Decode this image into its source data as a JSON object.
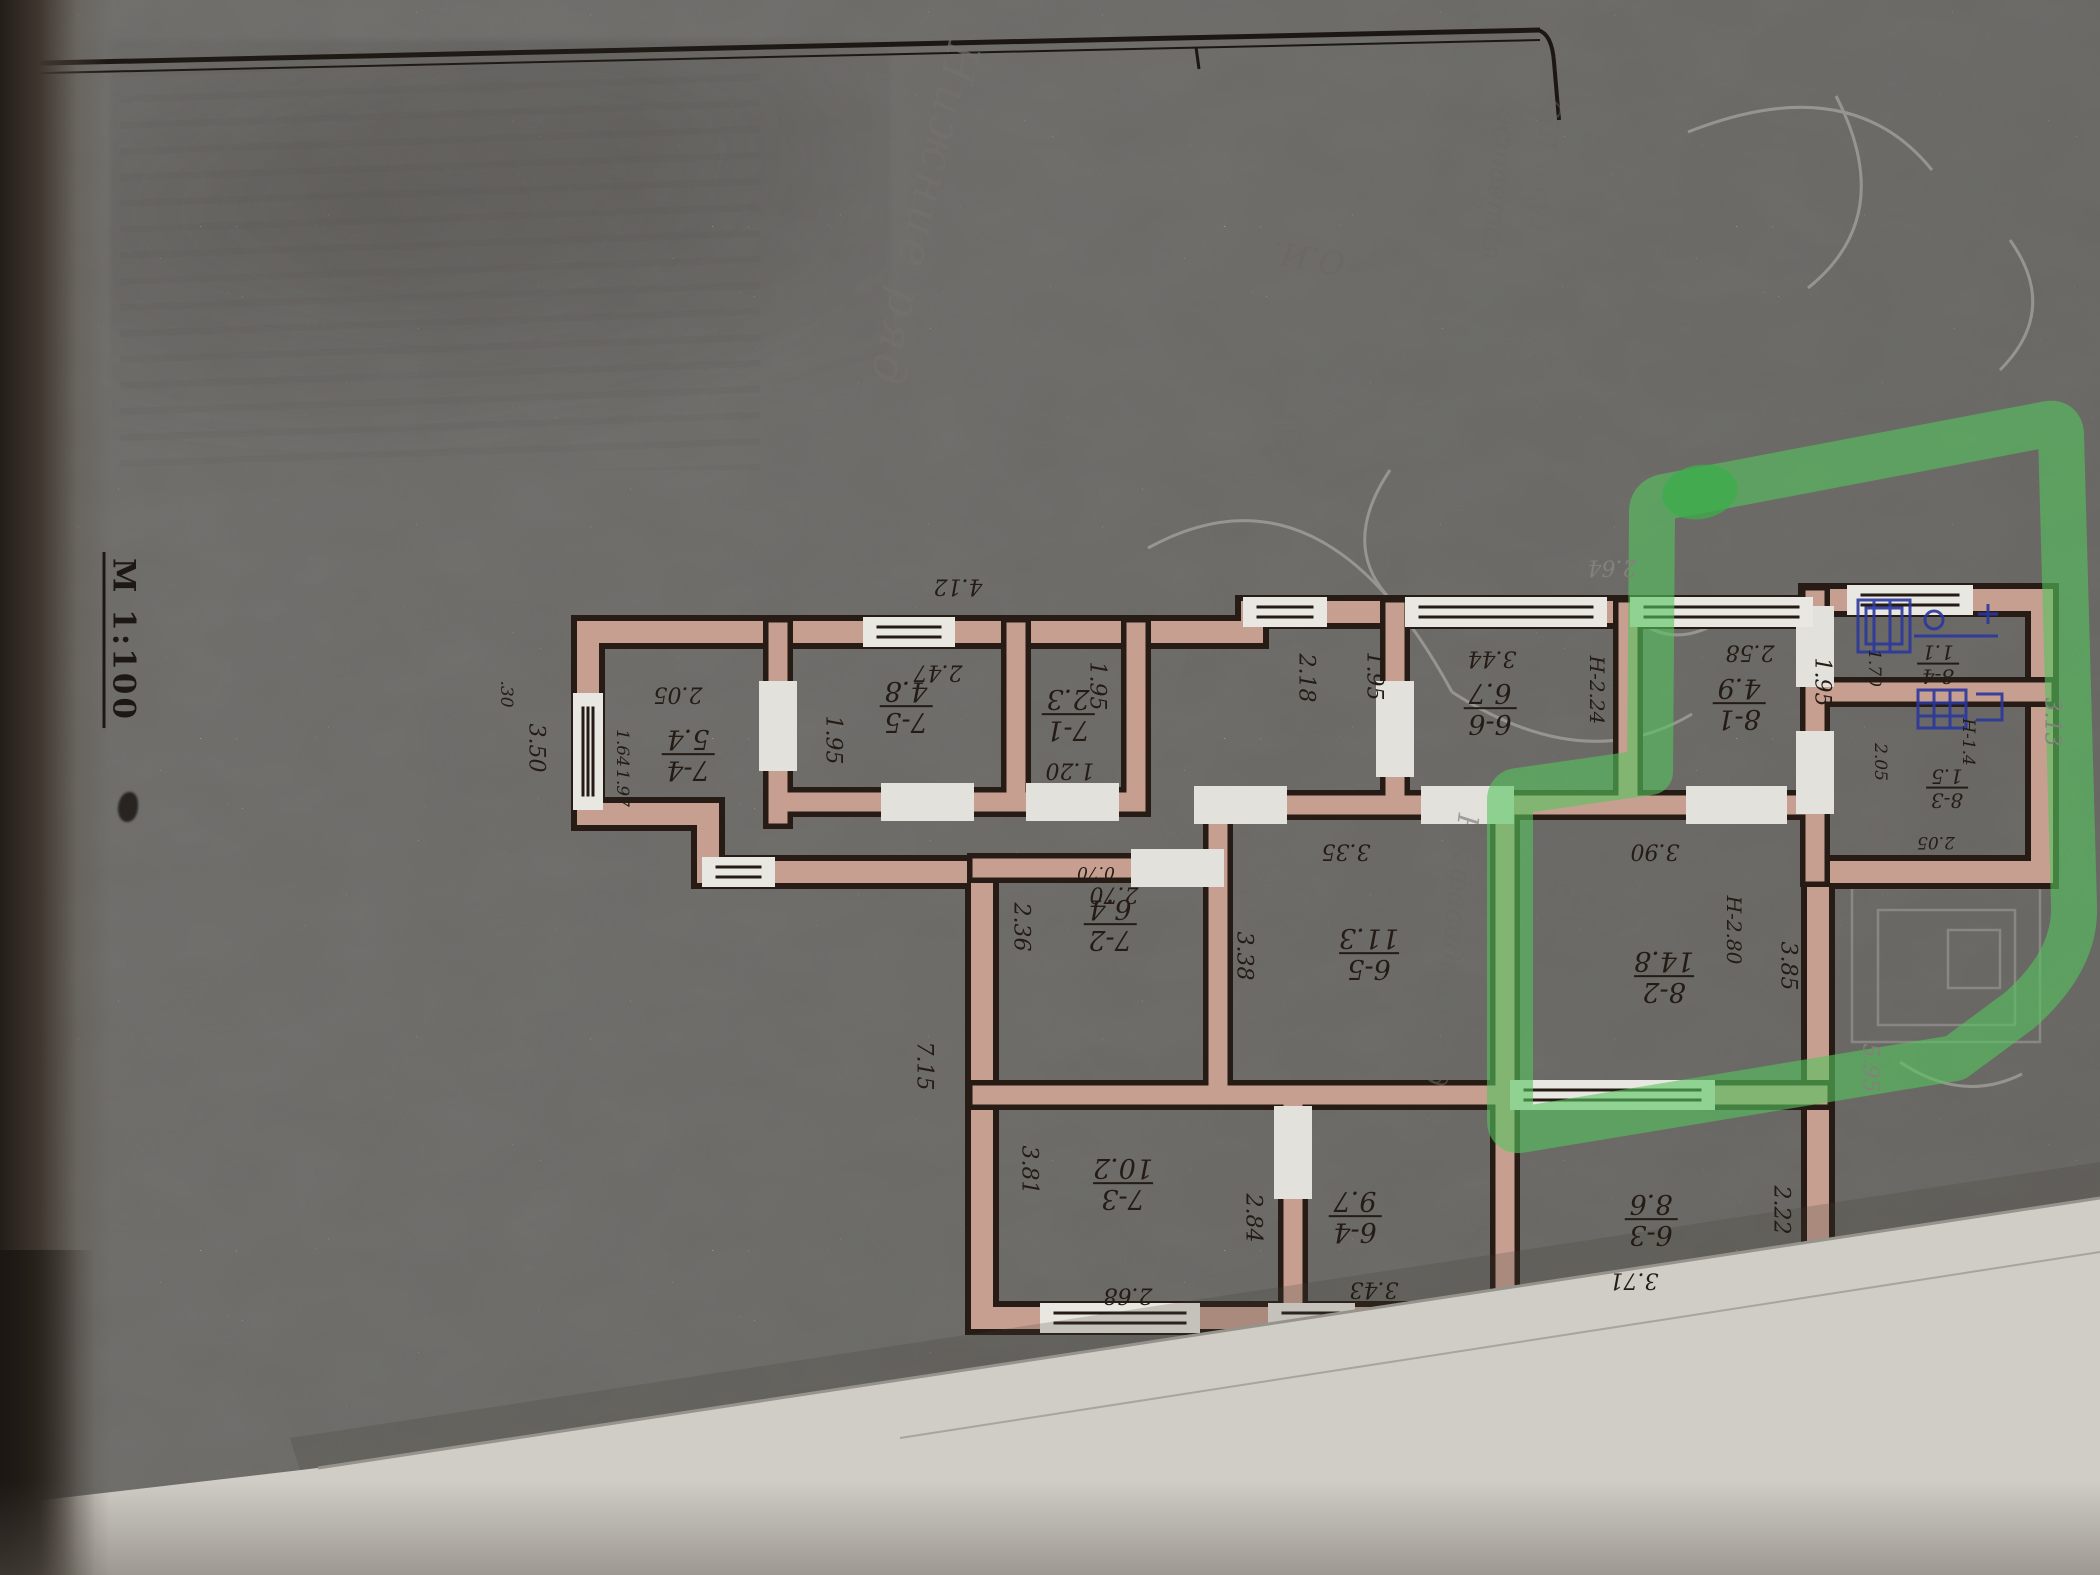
{
  "plan": {
    "scale_label": "М 1:100",
    "rooms": [
      {
        "num": "7-4",
        "area": "5.4"
      },
      {
        "num": "7-5",
        "area": "4.8"
      },
      {
        "num": "7-1",
        "area": "2.3"
      },
      {
        "num": "6-6",
        "area": "6.7"
      },
      {
        "num": "8-1",
        "area": "4.9"
      },
      {
        "num": "8-4",
        "area": "1.1"
      },
      {
        "num": "8-3",
        "area": "1.5"
      },
      {
        "num": "8-2",
        "area": "14.8"
      },
      {
        "num": "7-2",
        "area": "6.4"
      },
      {
        "num": "6-5",
        "area": "11.3"
      },
      {
        "num": "7-3",
        "area": "10.2"
      },
      {
        "num": "6-4",
        "area": "9.7"
      },
      {
        "num": "6-3",
        "area": "8.6"
      }
    ],
    "dims": [
      {
        "v": "4.12"
      },
      {
        "v": "2.05"
      },
      {
        "v": "2.47"
      },
      {
        "v": "3.44"
      },
      {
        "v": "2.58"
      },
      {
        "v": "2.64"
      },
      {
        "v": "1.64"
      },
      {
        "v": "1.97"
      },
      {
        "v": "3.50"
      },
      {
        "v": ".30"
      },
      {
        "v": "1.95"
      },
      {
        "v": "1.95"
      },
      {
        "v": "1.20"
      },
      {
        "v": "0.70"
      },
      {
        "v": "2.18"
      },
      {
        "v": "1.95"
      },
      {
        "v": "Н-2.24"
      },
      {
        "v": "1.95"
      },
      {
        "v": "1.70"
      },
      {
        "v": "2.05"
      },
      {
        "v": "2.05"
      },
      {
        "v": "Н-1.4"
      },
      {
        "v": "3.13"
      },
      {
        "v": "3.90"
      },
      {
        "v": "Н-2.80"
      },
      {
        "v": "3.85"
      },
      {
        "v": "5.95"
      },
      {
        "v": "2.70"
      },
      {
        "v": "2.36"
      },
      {
        "v": "3.35"
      },
      {
        "v": "3.38"
      },
      {
        "v": "7.15"
      },
      {
        "v": "3.81"
      },
      {
        "v": "2.68"
      },
      {
        "v": "2.84"
      },
      {
        "v": "3.43"
      },
      {
        "v": "3.71"
      },
      {
        "v": "2.22"
      }
    ]
  },
  "handwriting": {
    "notes": [
      {
        "text": "Нижние ряд"
      },
      {
        "text": "О.И."
      },
      {
        "text": "остается"
      },
      {
        "text": "СПГ и суд"
      },
      {
        "text": "Общ"
      },
      {
        "text": "Р-к фасадни и суд"
      },
      {
        "text": "з"
      }
    ]
  },
  "colors": {
    "paper": "#e3e1db",
    "wall_fill": "#d9ae9f",
    "ink": "#241b15",
    "pencil": "#8b8a86",
    "highlighter": "#55c45e",
    "pen_blue": "#23309b"
  }
}
